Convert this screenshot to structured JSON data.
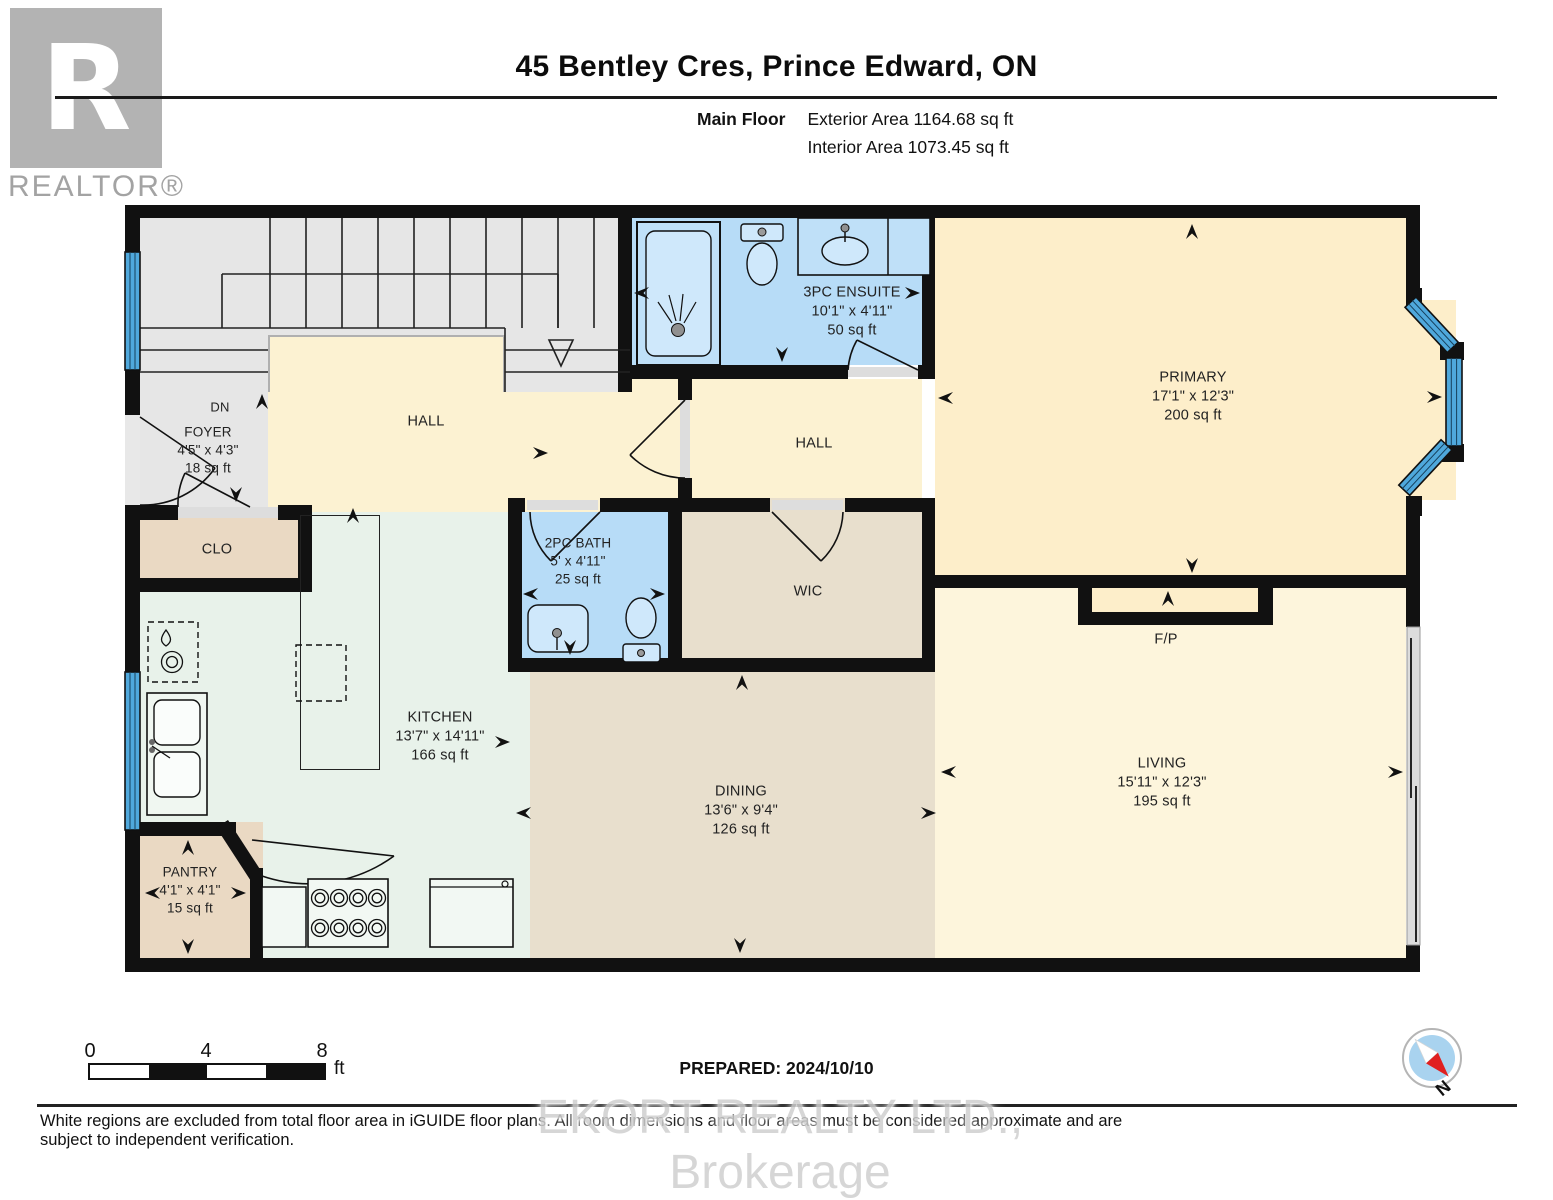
{
  "header": {
    "title": "45 Bentley Cres, Prince Edward, ON",
    "floor_label": "Main Floor",
    "exterior_area": "Exterior Area 1164.68 sq ft",
    "interior_area": "Interior Area 1073.45 sq ft",
    "logo_letter": "R",
    "brand": "REALTOR®"
  },
  "rooms": {
    "foyer": {
      "name": "FOYER",
      "dims": "4'5\" x 4'3\"",
      "area": "18 sq ft"
    },
    "hall_upper": {
      "name": "HALL"
    },
    "ensuite": {
      "name": "3PC ENSUITE",
      "dims": "10'1\" x 4'11\"",
      "area": "50 sq ft"
    },
    "hall_inner": {
      "name": "HALL"
    },
    "primary": {
      "name": "PRIMARY",
      "dims": "17'1\" x 12'3\"",
      "area": "200 sq ft"
    },
    "closet": {
      "name": "CLO"
    },
    "bath": {
      "name": "2PC BATH",
      "dims": "5' x 4'11\"",
      "area": "25 sq ft"
    },
    "wic": {
      "name": "WIC"
    },
    "kitchen": {
      "name": "KITCHEN",
      "dims": "13'7\" x 14'11\"",
      "area": "166 sq ft"
    },
    "dining": {
      "name": "DINING",
      "dims": "13'6\" x 9'4\"",
      "area": "126 sq ft"
    },
    "living": {
      "name": "LIVING",
      "dims": "15'11\" x 12'3\"",
      "area": "195 sq ft"
    },
    "pantry": {
      "name": "PANTRY",
      "dims": "4'1\" x 4'1\"",
      "area": "15 sq ft"
    },
    "fireplace": {
      "name": "F/P"
    },
    "stairs": {
      "label": "DN"
    }
  },
  "footer": {
    "scale": {
      "ticks": [
        "0",
        "4",
        "8"
      ],
      "unit": "ft"
    },
    "prepared": "PREPARED: 2024/10/10",
    "compass_n": "N",
    "disclaimer": "White regions are excluded from total floor area in iGUIDE floor plans. All room dimensions and floor areas must be considered approximate and are subject to independent verification.",
    "watermark": "EKORT REALTY LTD., Brokerage"
  },
  "colors": {
    "wall": "#111111",
    "window_blue": "#4fa8dc",
    "bathroom_blue": "#b7dcf7",
    "bedroom_cream": "#fdeeca",
    "hall_cream": "#fcf2d2",
    "living_cream": "#fdf5dc",
    "kitchen_green": "#e8f2ea",
    "dining_tan": "#e8dfcd",
    "closet_tan": "#ead9c3",
    "stairs_gray": "#e6e6e6",
    "compass_red": "#e02020"
  }
}
